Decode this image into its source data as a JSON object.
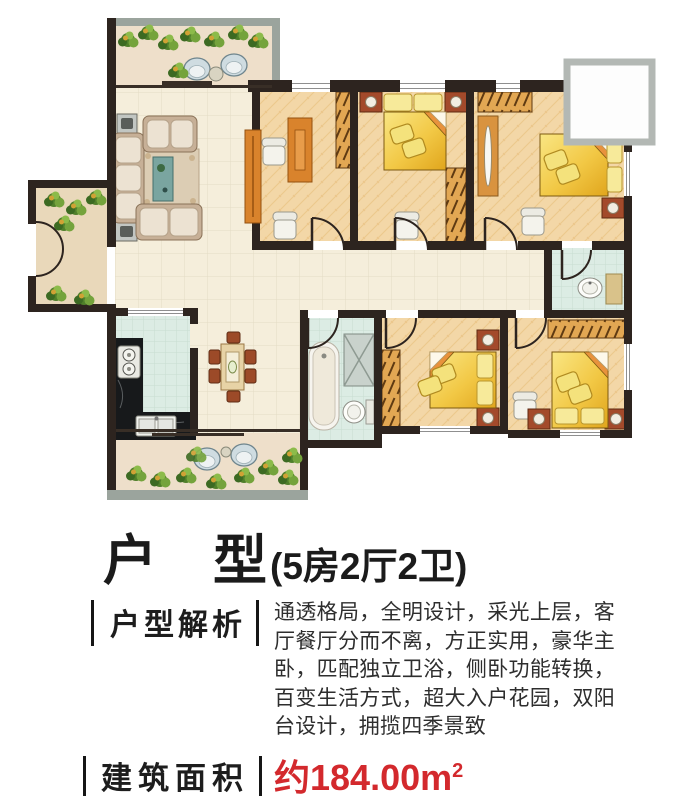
{
  "colors": {
    "accent_red": "#d3292d",
    "text_dark": "#1d1d1d",
    "wall": "#2d241f",
    "tile_floor": "#f5eedb",
    "bedroom_floor": "#f3d7a7",
    "bath_floor": "#dcece4",
    "balcony_floor": "#eedfca",
    "balcony_frame": "#9ba49d",
    "bed_gold": "#f2c845",
    "wardrobe_tan": "#e2a753",
    "plant_green": "#4f7f2a"
  },
  "plan": {
    "spaces": [
      "upper-balcony",
      "living-room",
      "dining-room",
      "entry-garden",
      "kitchen",
      "lower-balcony",
      "study-room",
      "bedroom-2",
      "master-bedroom",
      "master-bathroom",
      "bathroom",
      "bedroom-4",
      "bedroom-5",
      "corridor",
      "bay-window"
    ]
  },
  "title": {
    "main": "户　型",
    "detail": "(5房2厅2卫)"
  },
  "analysis": {
    "label": "户型解析",
    "body": "通透格局，全明设计，采光上层，客厅餐厅分而不离，方正实用，豪华主卧，匹配独立卫浴，侧卧功能转换，百变生活方式，超大入户花园，双阳台设计，拥揽四季景致"
  },
  "area": {
    "label": "建筑面积",
    "value": "约184.00m",
    "sup": "2"
  }
}
